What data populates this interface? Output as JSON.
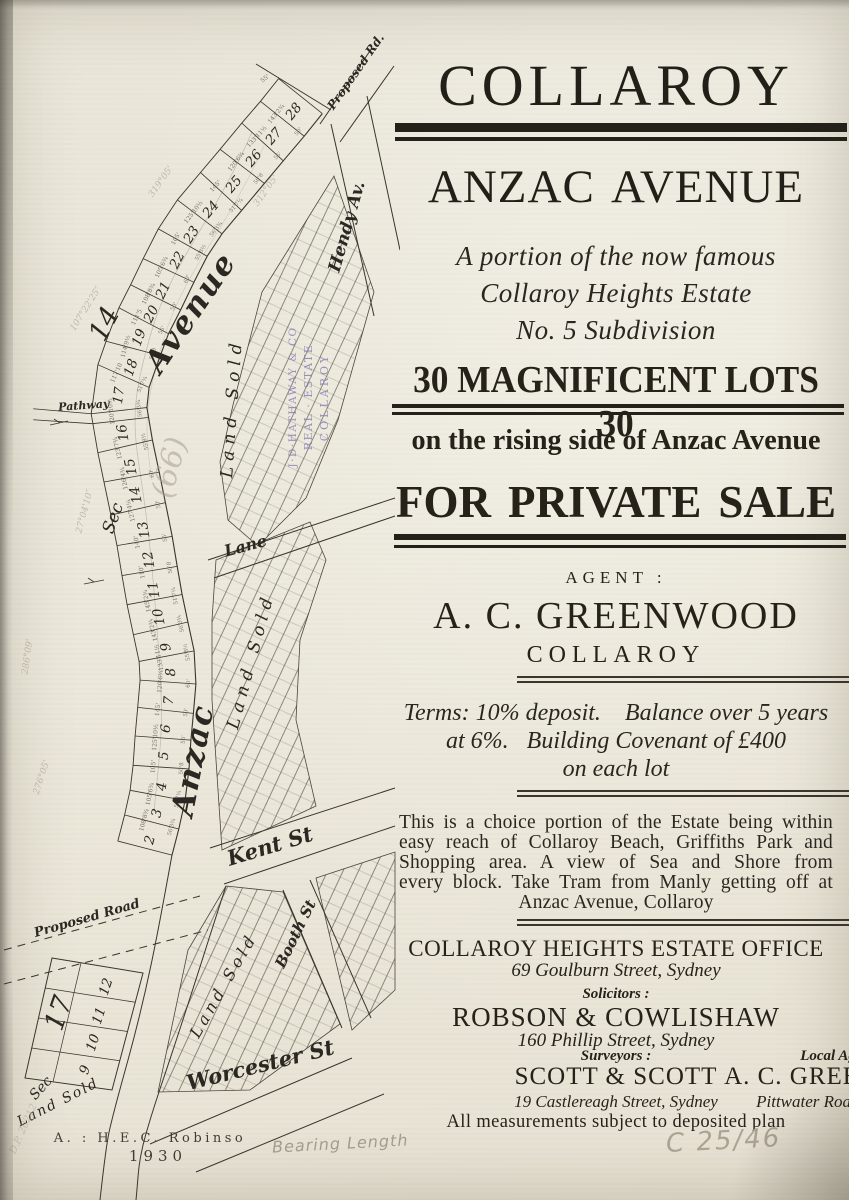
{
  "poster": {
    "title": "COLLAROY",
    "subtitle": "ANZAC AVENUE",
    "tagline_lines": [
      "A portion of the now famous",
      "Collaroy Heights Estate",
      "No. 5 Subdivision"
    ],
    "lots_banner": "30 MAGNIFICENT LOTS 30",
    "rising_side": "on the rising side of Anzac Avenue",
    "sale_banner": "FOR PRIVATE SALE",
    "agent_label": "AGENT :",
    "agent_name": "A. C. GREENWOOD",
    "agent_location": "COLLAROY",
    "terms_lines": [
      "Terms: 10% deposit.    Balance over 5 years",
      "at 6%.   Building Covenant of £400",
      "on each lot"
    ],
    "description_lines": [
      "This is a choice portion of the Estate being within",
      "easy reach of Collaroy Beach, Griffiths Park and",
      "Shopping area.  A view of Sea and Shore from",
      "every block. Take Tram from Manly getting off at",
      "Anzac Avenue, Collaroy"
    ],
    "office_name": "COLLAROY HEIGHTS ESTATE OFFICE",
    "office_address": "69 Goulburn Street, Sydney",
    "solicitors_label": "Solicitors :",
    "solicitors_name": "ROBSON & COWLISHAW",
    "solicitors_address": "160 Phillip Street, Sydney",
    "surveyors_label": "Surveyors :",
    "surveyors_name": "SCOTT & SCOTT",
    "surveyors_address": "19 Castlereagh Street, Sydney",
    "local_agent_label": "Local Agent :",
    "local_agent_name": "A. C. GREENWOOD",
    "local_agent_address": "Pittwater Road, Collaroy",
    "footnote": "All measurements subject to deposited plan"
  },
  "map": {
    "labels": {
      "proposed_rd": "Proposed Rd.",
      "hendy_av": "Hendy Av.",
      "avenue": "Avenue",
      "anzac": "Anzac",
      "lane": "Lane",
      "kent_st": "Kent St",
      "booth_st": "Booth St",
      "worcester_st": "Worcester St",
      "proposed_road": "Proposed Road",
      "pathway": "Pathway",
      "land_sold": "Land Sold",
      "sec": "Sec",
      "sec_14": "14",
      "sec_17": "17"
    },
    "strip_lots": [
      "28",
      "27",
      "26",
      "25",
      "24",
      "23",
      "22",
      "21",
      "20",
      "19",
      "18",
      "17",
      "16",
      "15",
      "14",
      "13",
      "12",
      "11",
      "10",
      "9",
      "8",
      "7",
      "6",
      "5",
      "4",
      "3",
      "2"
    ],
    "sec17_lots": [
      "12",
      "11",
      "10",
      "9"
    ],
    "depth_dims": [
      "143'2¾",
      "133'11½",
      "120'6¾",
      "145'",
      "125'10½",
      "105'",
      "105'6¾",
      "108'8¾",
      "111'5",
      "114'9½",
      "117'10",
      "120'10½",
      "123'7¾",
      "126'4¾",
      "127'4¼",
      "140'",
      "110'",
      "145'2¾"
    ],
    "frontage_dims": [
      "50'",
      "55'",
      "50'8",
      "51'7¼",
      "56'3¾",
      "55'8½",
      "60'"
    ],
    "top_dim": "55'",
    "bearings": [
      "319°05'",
      "107°22'25″",
      "312°05'",
      "27°04'10″",
      "286°09'",
      "276°05'"
    ]
  },
  "annotations": {
    "stamp": {
      "lines": [
        "J·D·HATHAWAY & CO",
        "REAL · ESTATE",
        "COLLAROY"
      ],
      "color": "#8579b2"
    },
    "pencil": {
      "bearing_length": "Bearing Length",
      "file_ref": "C 25/46",
      "dp_ref": "D.P. 20212",
      "lot_note": "(66)"
    },
    "printer": {
      "credit": "A. : H.E.C. Robinso",
      "year": "1930"
    }
  }
}
